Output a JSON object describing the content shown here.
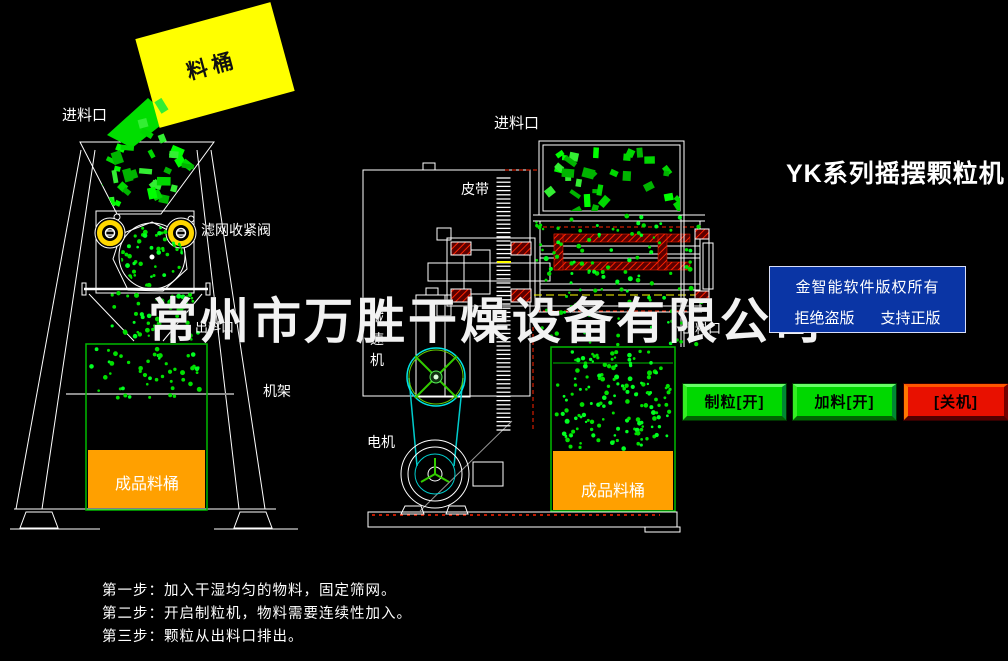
{
  "title": "YK系列摇摆颗粒机",
  "watermark": "常州市万胜干燥设备有限公司",
  "copyright_box": {
    "line1": "金智能软件版权所有",
    "line2_left": "拒绝盗版",
    "line2_right": "支持正版"
  },
  "buttons": {
    "granulate": "制粒[开]",
    "feed": "加料[开]",
    "shutdown": "[关机]"
  },
  "labels": {
    "bucket": "料桶",
    "inlet": "进料口",
    "filter_valve": "滤网收紧阀",
    "outlet": "出料口",
    "frame": "机架",
    "product_bucket": "成品料桶",
    "belt": "皮带",
    "reducer": "减速机",
    "motor": "电机"
  },
  "instructions": [
    "第一步：加入干湿均匀的物料，固定筛网。",
    "第二步：开启制粒机，物料需要连续性加入。",
    "第三步：颗粒从出料口排出。"
  ],
  "colors": {
    "particle_green": "#00e000",
    "particle_bright": "#00ff22",
    "chunk_greens": [
      "#00ff00",
      "#00d800",
      "#33ee33",
      "#00b400"
    ],
    "bucket_yellow": "#ffff00",
    "product_orange": "#ffa000",
    "container_green": "#00bb00",
    "line_white": "#ffffff",
    "hatch_red": "#ff2200",
    "belt_cyan": "#00cccc",
    "copyright_blue": "#0a35a5",
    "button_green": "#00d800",
    "button_red": "#e81000"
  }
}
